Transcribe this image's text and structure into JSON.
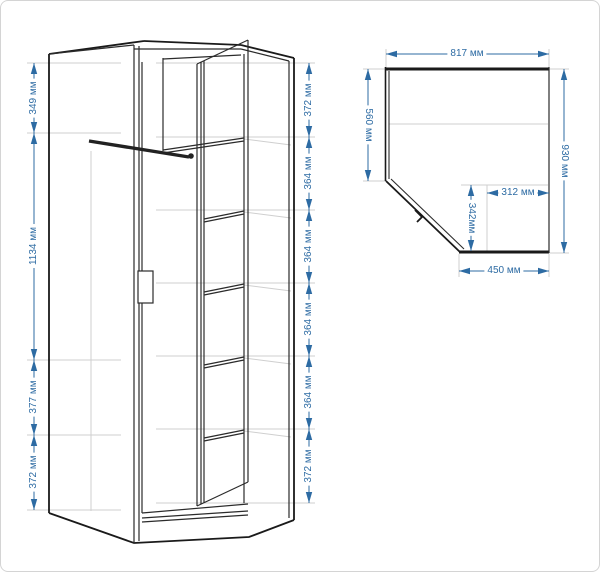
{
  "title": "Чертёж углового шкафа с размерами",
  "colors": {
    "dimension_blue": "#2d6ba3",
    "line_dark": "#1a1a1a",
    "line_faint": "#c9c9c9",
    "background": "#ffffff"
  },
  "front_view": {
    "name": "front-perspective-view",
    "left_dims": [
      {
        "label": "349 мм"
      },
      {
        "label": "1134 мм"
      },
      {
        "label": "377 мм"
      },
      {
        "label": "372 мм"
      }
    ],
    "right_dims": [
      {
        "label": "372 мм"
      },
      {
        "label": "364 мм"
      },
      {
        "label": "364 мм"
      },
      {
        "label": "364 мм"
      },
      {
        "label": "364 мм"
      },
      {
        "label": "372 мм"
      }
    ]
  },
  "top_view": {
    "name": "top-plan-view",
    "top_width": {
      "label": "817 мм"
    },
    "left_depth": {
      "label": "560 мм"
    },
    "right_depth": {
      "label": "930 мм"
    },
    "inner_width": {
      "label": "312 мм"
    },
    "inner_depth": {
      "label": "342мм"
    },
    "bottom_width": {
      "label": "450 мм"
    }
  }
}
